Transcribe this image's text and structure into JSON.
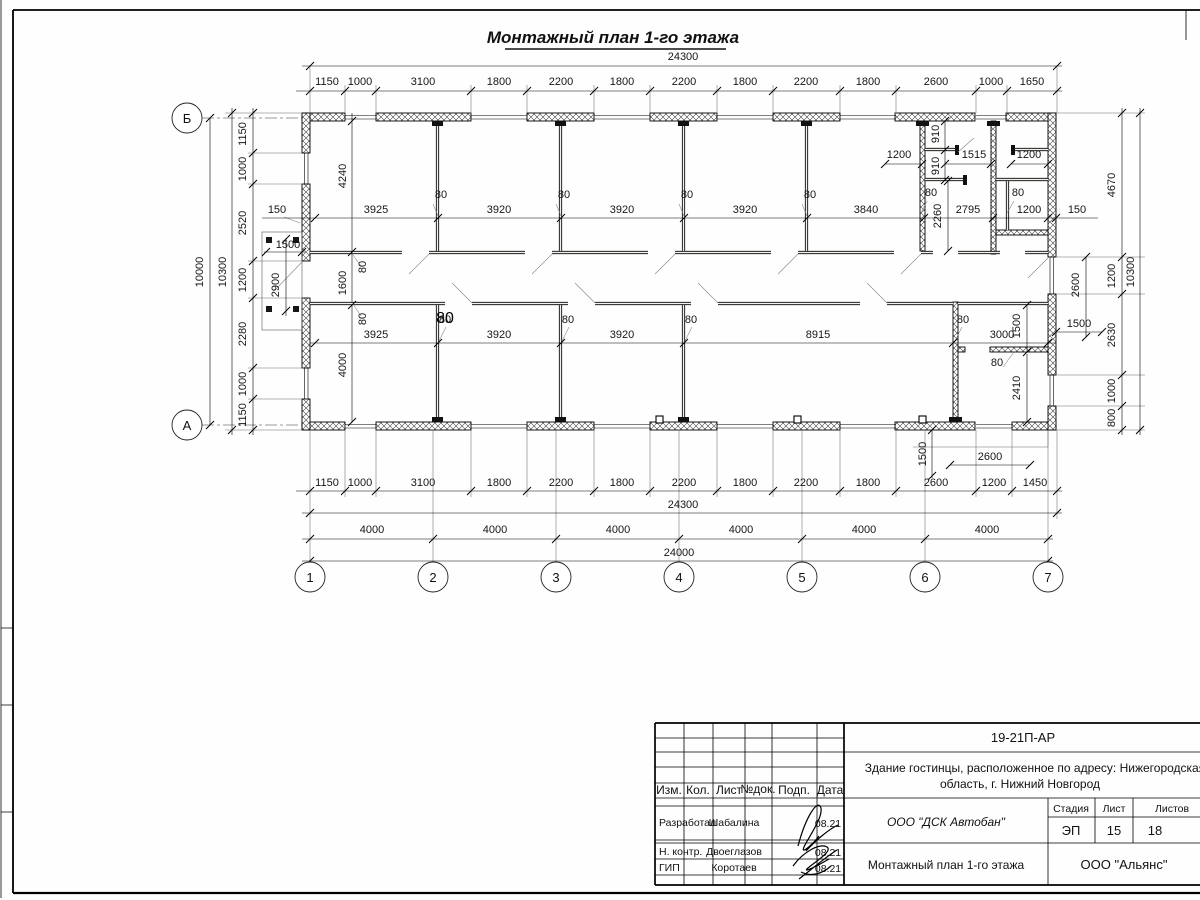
{
  "sheet": {
    "title": "Монтажный план 1-го этажа"
  },
  "axes": {
    "cols": [
      "1",
      "2",
      "3",
      "4",
      "5",
      "6",
      "7"
    ],
    "rows": [
      "Б",
      "А"
    ]
  },
  "dims": {
    "top_total": "24300",
    "top": [
      "1150",
      "1000",
      "3100",
      "1800",
      "2200",
      "1800",
      "2200",
      "1800",
      "2200",
      "1800",
      "2600",
      "1000",
      "1650"
    ],
    "bottom": [
      "1150",
      "1000",
      "3100",
      "1800",
      "2200",
      "1800",
      "2200",
      "1800",
      "2200",
      "1800",
      "2600",
      "1200",
      "1450"
    ],
    "bottom_total": "24300",
    "bottom_axes": [
      "4000",
      "4000",
      "4000",
      "4000",
      "4000",
      "4000"
    ],
    "bottom_axes_total": "24000",
    "left": [
      "1150",
      "1000",
      "2520",
      "1200",
      "2280",
      "1000",
      "1150"
    ],
    "left_total_outer": "10000",
    "left_total_inner": "10300",
    "right": [
      "4670",
      "1200",
      "2630",
      "1000",
      "800"
    ],
    "right_total": "10300"
  },
  "plan": {
    "depth_top": "4240",
    "corridor": "1600",
    "depth_bottom": "4000",
    "t80": "80",
    "rooms_top": [
      "3925",
      "3920",
      "3920",
      "3920",
      "3840"
    ],
    "rooms_bottom": [
      "3925",
      "3920",
      "3920",
      "8915",
      "3000"
    ],
    "san_row": [
      "1200",
      "1515",
      "1200"
    ],
    "san_910": [
      "910",
      "910"
    ],
    "san_2260": "2260",
    "san_2795": "2795",
    "san_1200": "1200",
    "left_150": "150",
    "right_150": "150",
    "porch_left": {
      "w": "1500",
      "d": "2900"
    },
    "right_gap_2600": "2600",
    "right_gap_1500": "1500",
    "gap_1500": "1500",
    "room_2410": "2410",
    "porch_right": {
      "w": "2600",
      "d": "1500"
    }
  },
  "title_block": {
    "code": "19-21П-АР",
    "object_line1": "Здание гостинцы, расположенное по адресу: Нижегородская",
    "object_line2": "область, г. Нижний Новгород",
    "contractor": "ООО \"ДСК Автобан\"",
    "drawing_name": "Монтажный план 1-го этажа",
    "org": "ООО \"Альянс\"",
    "stage_label": "Стадия",
    "sheet_label": "Лист",
    "sheets_label": "Листов",
    "stage": "ЭП",
    "sheet": "15",
    "sheets": "18",
    "cols": [
      "Изм.",
      "Кол.",
      "Лист",
      "№док.",
      "Подп.",
      "Дата"
    ],
    "rows": [
      {
        "role": "Разработал",
        "name": "Шабалина",
        "date": "08.21"
      },
      {
        "role": "Н. контр.",
        "name": "Двоеглазов",
        "date": "08.21"
      },
      {
        "role": "ГИП",
        "name": "Коротаев",
        "date": "08.21"
      }
    ]
  }
}
